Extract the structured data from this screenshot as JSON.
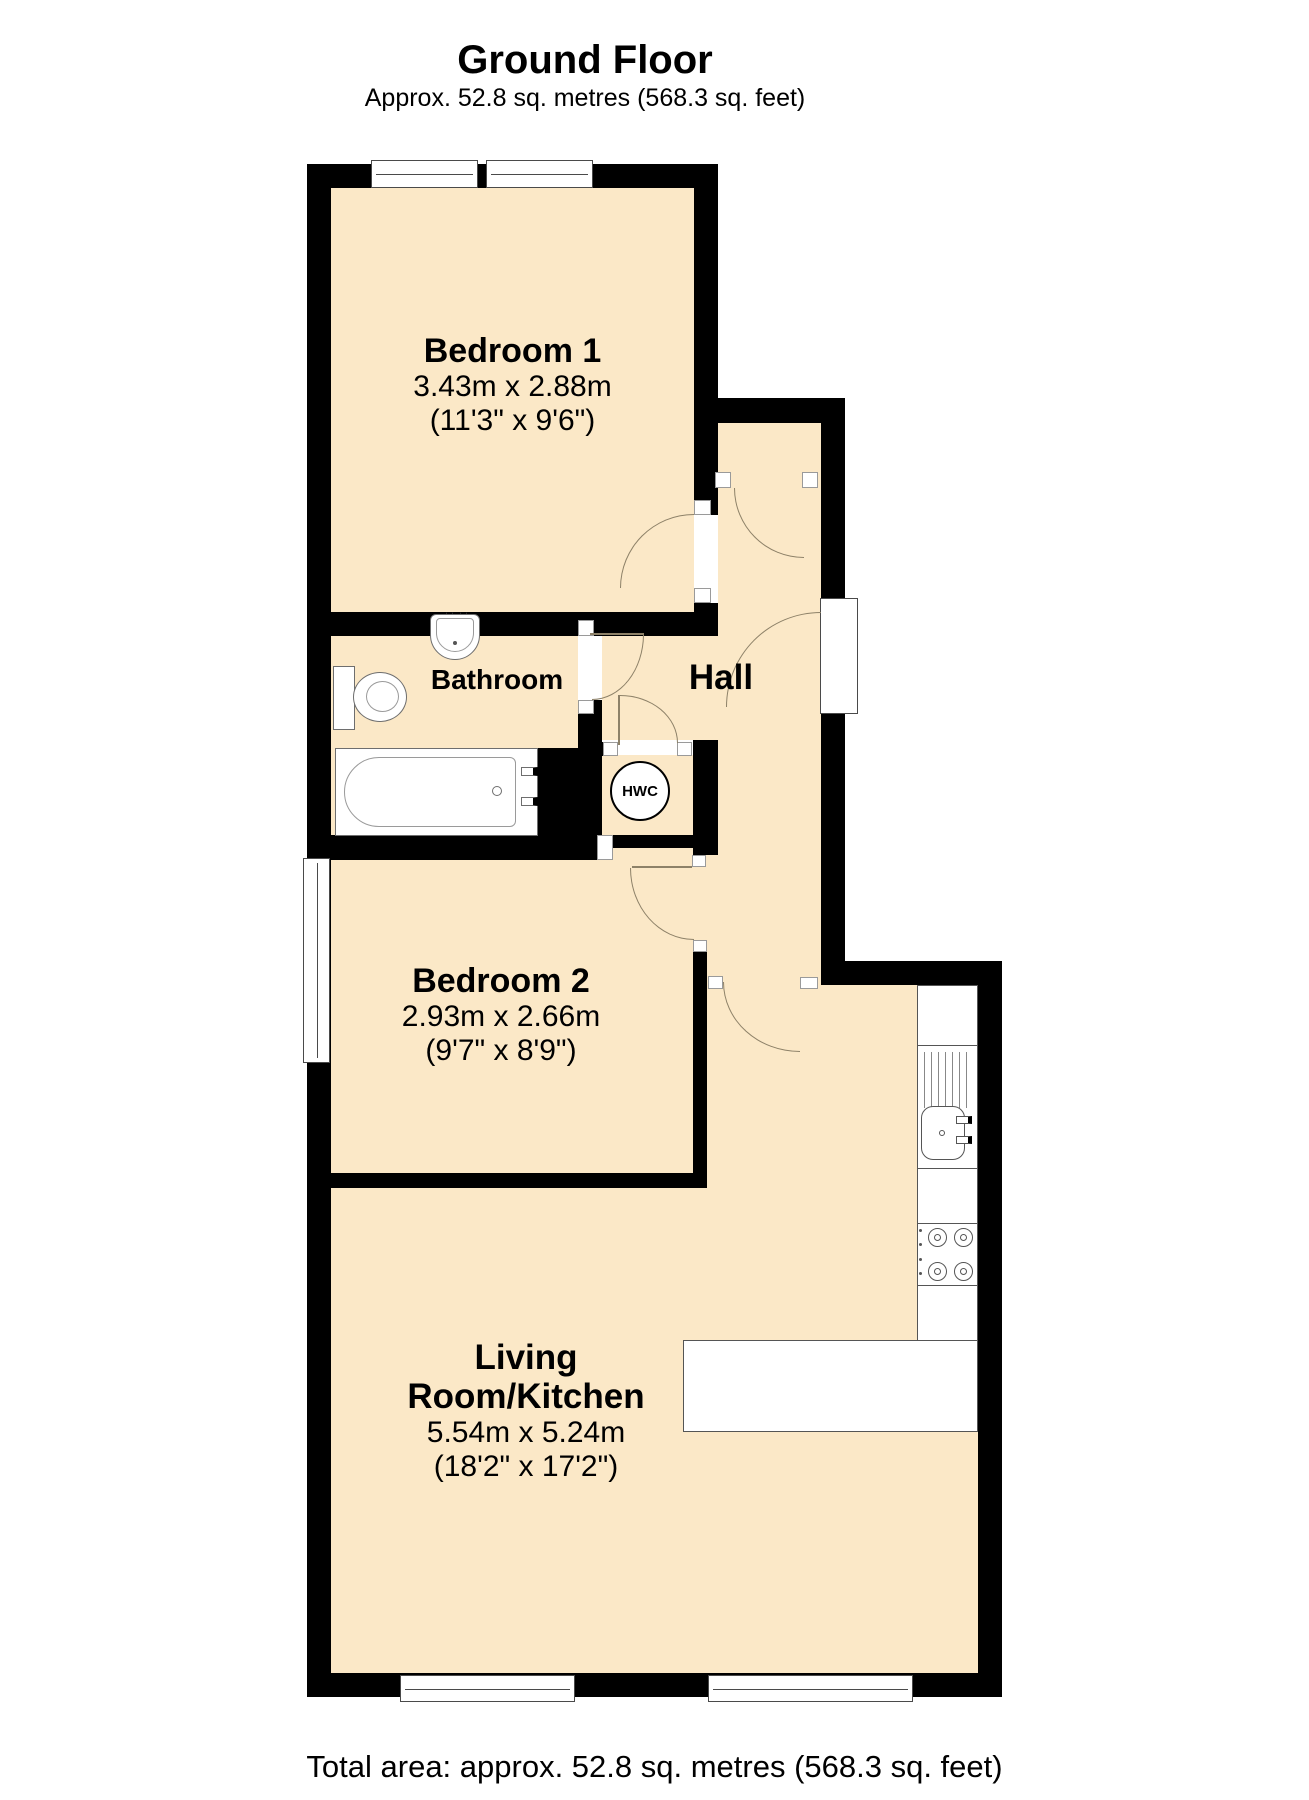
{
  "title": "Ground Floor",
  "subtitle": "Approx. 52.8 sq. metres (568.3 sq. feet)",
  "footer": "Total area: approx. 52.8 sq. metres (568.3 sq. feet)",
  "rooms": {
    "bedroom1": {
      "name": "Bedroom 1",
      "dimensions_metric": "3.43m x 2.88m",
      "dimensions_imperial": "(11'3\" x 9'6\")"
    },
    "bathroom": {
      "name": "Bathroom"
    },
    "hall": {
      "name": "Hall"
    },
    "hwc": {
      "label": "HWC"
    },
    "bedroom2": {
      "name": "Bedroom 2",
      "dimensions_metric": "2.93m x 2.66m",
      "dimensions_imperial": "(9'7\" x 8'9\")"
    },
    "living_room_kitchen": {
      "name_line1": "Living",
      "name_line2": "Room/Kitchen",
      "dimensions_metric": "5.54m x 5.24m",
      "dimensions_imperial": "(18'2\" x 17'2\")"
    }
  },
  "colors": {
    "floor": "#fbe8c7",
    "wall": "#000000"
  }
}
